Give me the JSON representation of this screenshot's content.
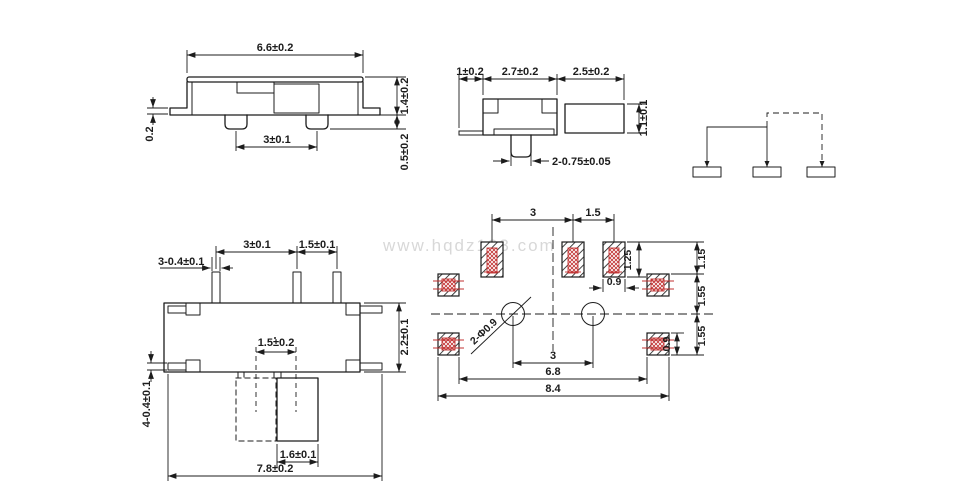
{
  "watermark": "www.hqdz123.com",
  "colors": {
    "line": "#1c1c1c",
    "accent_red": "#c03030",
    "watermark": "#d8d8d8",
    "background": "#ffffff"
  },
  "side_view": {
    "overall_width": "6.6±0.2",
    "body_height": "1.4±0.2",
    "leg_thickness": "0.2",
    "pin_pitch": "3±0.1",
    "standoff_height": "0.5±0.2"
  },
  "end_view": {
    "leg_length": "1±0.2",
    "body_width": "2.7±0.2",
    "knob_length": "2.5±0.2",
    "knob_height": "1.1±0.1",
    "pin_width": "2-0.75±0.05"
  },
  "top_view": {
    "pin_width": "3-0.4±0.1",
    "pin_pitch_a": "3±0.1",
    "pin_pitch_b": "1.5±0.1",
    "body_depth": "2.2±0.1",
    "travel": "1.5±0.2",
    "tab_width": "4-0.4±0.1",
    "knob_width": "1.6±0.1",
    "overall_width": "7.8±0.2"
  },
  "land_pattern": {
    "pad_pitch_a": "3",
    "pad_pitch_b": "1.5",
    "pad_length": "1.25",
    "pad_width": "0.9",
    "row_top": "1.15",
    "row_mid": "1.55",
    "row_bottom": "1.55",
    "side_pad_width": "0.9",
    "holes": "2-Φ0.9",
    "hole_pitch": "3",
    "span_inner": "6.8",
    "span_outer": "8.4"
  }
}
